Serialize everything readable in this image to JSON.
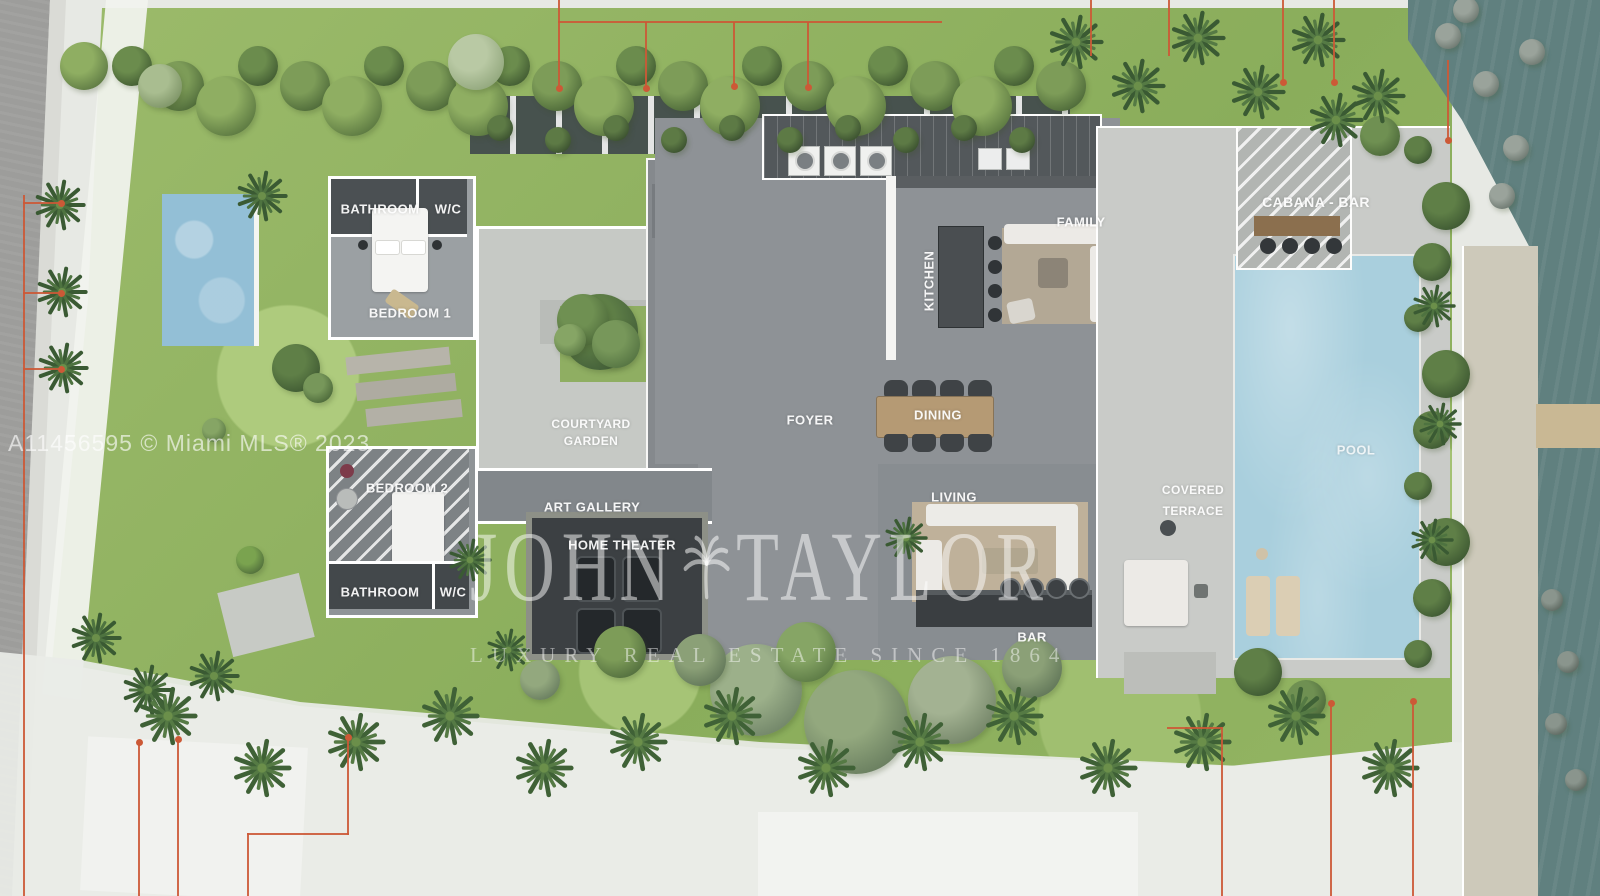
{
  "plan": {
    "rooms": {
      "bathroom_1": "BATHROOM",
      "wc_1": "W/C",
      "bedroom_1": "BEDROOM 1",
      "bedroom_2": "BEDROOM 2",
      "bathroom_2": "BATHROOM",
      "wc_2": "W/C",
      "courtyard_l1": "COURTYARD",
      "courtyard_l2": "GARDEN",
      "art_gallery": "ART GALLERY",
      "home_theater": "HOME THEATER",
      "foyer": "FOYER",
      "kitchen": "KITCHEN",
      "family": "FAMILY",
      "dining": "DINING",
      "living": "LIVING",
      "bar": "BAR",
      "covered_l1": "COVERED",
      "covered_l2": "TERRACE",
      "pool": "POOL",
      "cabana_bar": "CABANA - BAR"
    },
    "watermarks": {
      "mls": "A11456595 © Miami MLS® 2023",
      "brand_word_1": "JOHN",
      "brand_word_2": "TAYLOR",
      "brand_subtitle": "LUXURY REAL ESTATE SINCE 1864"
    },
    "colors": {
      "pool_water": "#a9cfdd",
      "canal_water": "#60807f",
      "lawn": "#96b765",
      "survey_line": "#cc5936",
      "main_slab": "#8e9296",
      "terrace": "#c9cbc8",
      "dark_roof": "#53585b"
    }
  }
}
